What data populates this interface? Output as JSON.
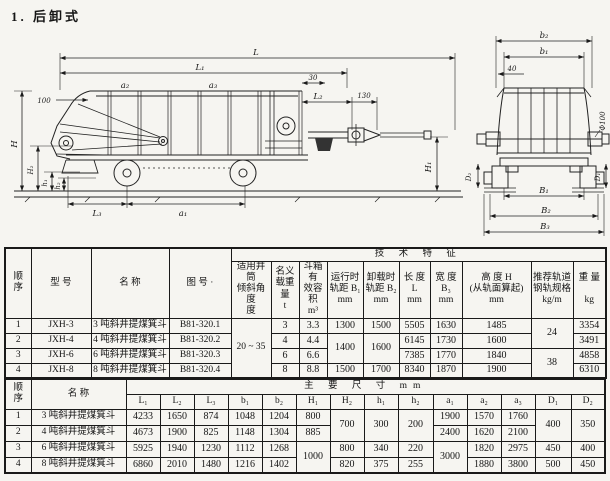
{
  "title": "1.  后卸式",
  "drawing": {
    "side_labels": {
      "L": "L",
      "L1": "L₁",
      "d30": "30",
      "d100": "100",
      "a2": "a₂",
      "a3": "a₃",
      "L2": "L₂",
      "d130": "130",
      "H": "H",
      "H2": "H₂",
      "h1": "h₁",
      "h2": "h₂",
      "L3": "L₃",
      "a1": "a₁",
      "H1": "H₁"
    },
    "end_labels": {
      "b2": "b₂",
      "b1": "b₁",
      "d40": "40",
      "phi": "Φ100",
      "D2": "D₂",
      "D1": "D₁",
      "B1": "B₁",
      "B2": "B₂",
      "B3": "B₃"
    }
  },
  "t1": {
    "headers": {
      "seq": "顺\n序",
      "model": "型  号",
      "name": "名  称",
      "dwg": "图  号 ·",
      "tech": "技  术  特  征",
      "cols": [
        "适用井筒\n倾斜角度\n度",
        "名义\n载重量\nt",
        "斗箱有\n效容积\nm³",
        "运行时\n轨距 B₁\nmm",
        "卸载时\n轨距 B₂\nmm",
        "长 度\nL\nmm",
        "宽 度\nB₃\nmm",
        "高 度 H\n(从轨面算起)\nmm",
        "推荐轨道\n钢轨规格\nkg/m",
        "重 量\n\nkg"
      ]
    },
    "rows": [
      [
        "1",
        "JXH-3",
        "3 吨斜井提煤箕斗",
        "B81-320.1",
        "20 ~ 35",
        "3",
        "3.3",
        "1300",
        "1500",
        "5505",
        "1630",
        "1485",
        "24",
        "3354"
      ],
      [
        "2",
        "JXH-4",
        "4 吨斜井提煤箕斗",
        "B81-320.2",
        "4",
        "4.4",
        "1400",
        "1600",
        "6145",
        "1730",
        "1600",
        "3491"
      ],
      [
        "3",
        "JXH-6",
        "6 吨斜井提煤箕斗",
        "B81-320.3",
        "6",
        "6.6",
        "7385",
        "1770",
        "1840",
        "38",
        "4858"
      ],
      [
        "4",
        "JXH-8",
        "8 吨斜井提煤箕斗",
        "B81-320.4",
        "8",
        "8.8",
        "1500",
        "1700",
        "8340",
        "1870",
        "1900",
        "6310"
      ]
    ]
  },
  "t2": {
    "headers": {
      "seq": "顺\n序",
      "name": "名  称",
      "main": "主  要  尺  寸   mm",
      "cols": [
        "L₁",
        "L₂",
        "L₃",
        "b₁",
        "b₂",
        "H₁",
        "H₂",
        "h₁",
        "h₂",
        "a₁",
        "a₂",
        "a₃",
        "D₁",
        "D₂"
      ]
    },
    "rows": [
      [
        "1",
        "3 吨斜井提煤箕斗",
        "4233",
        "1650",
        "874",
        "1048",
        "1204",
        "800",
        "700",
        "300",
        "200",
        "1900",
        "1570",
        "1760",
        "400",
        "350"
      ],
      [
        "2",
        "4 吨斜井提煤箕斗",
        "4673",
        "1900",
        "825",
        "1148",
        "1304",
        "885",
        "2400",
        "1620",
        "2100"
      ],
      [
        "3",
        "6 吨斜井提煤箕斗",
        "5925",
        "1940",
        "1230",
        "1112",
        "1268",
        "1000",
        "800",
        "340",
        "220",
        "3000",
        "1820",
        "2975",
        "450",
        "400"
      ],
      [
        "4",
        "8 吨斜井提煤箕斗",
        "6860",
        "2010",
        "1480",
        "1216",
        "1402",
        "820",
        "375",
        "255",
        "1880",
        "3800",
        "500",
        "450"
      ]
    ]
  }
}
